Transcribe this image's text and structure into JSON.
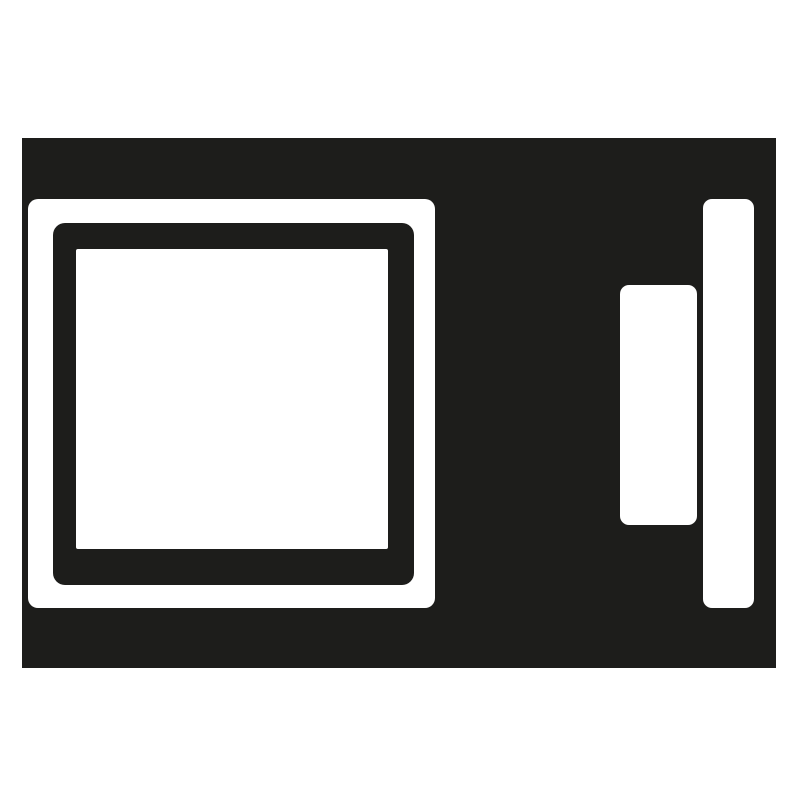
{
  "icon": {
    "name": "microwave-oven-icon",
    "description": "Black and white pictogram of a microwave oven: dark body, large square door window on the left, control button and vertical handle bar on the right",
    "colors": {
      "foreground": "#1d1d1b",
      "background": "#ffffff"
    },
    "parts": {
      "body": "appliance body",
      "door_frame": "door window outer frame",
      "door_inner": "door window inner ring",
      "door_glass": "door window glass pane",
      "control_button": "control panel button",
      "handle_bar": "door handle bar"
    }
  }
}
